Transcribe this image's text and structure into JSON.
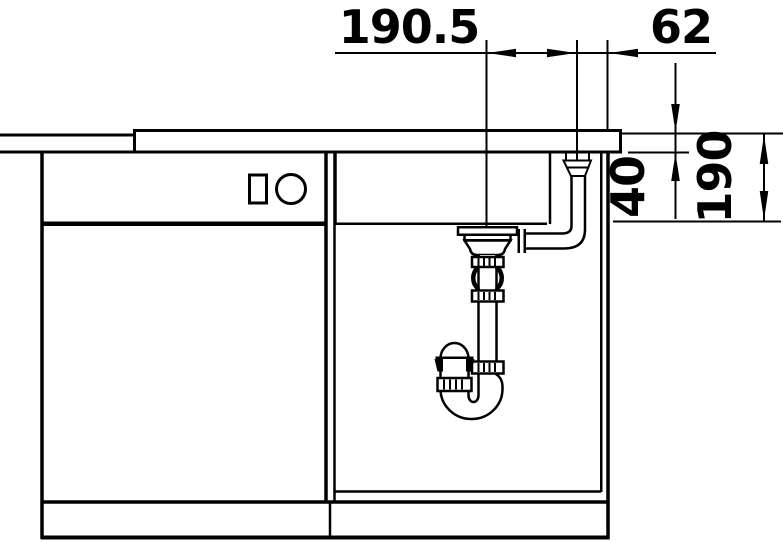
{
  "diagram": {
    "type": "technical-section-drawing",
    "subject": "kitchen-sink-cabinet-installation-side-section",
    "background_color": "#ffffff",
    "line_color": "#000000",
    "dimensions": [
      {
        "id": "drain-to-overflow-offset",
        "label": "190.5",
        "orientation": "horizontal",
        "position": "top"
      },
      {
        "id": "overflow-to-cabinet-side",
        "label": "62",
        "orientation": "horizontal",
        "position": "top-right"
      },
      {
        "id": "worktop-thickness",
        "label": "40",
        "orientation": "vertical-rotated",
        "position": "right"
      },
      {
        "id": "bowl-depth",
        "label": "190",
        "orientation": "vertical-rotated",
        "position": "far-right"
      }
    ]
  }
}
